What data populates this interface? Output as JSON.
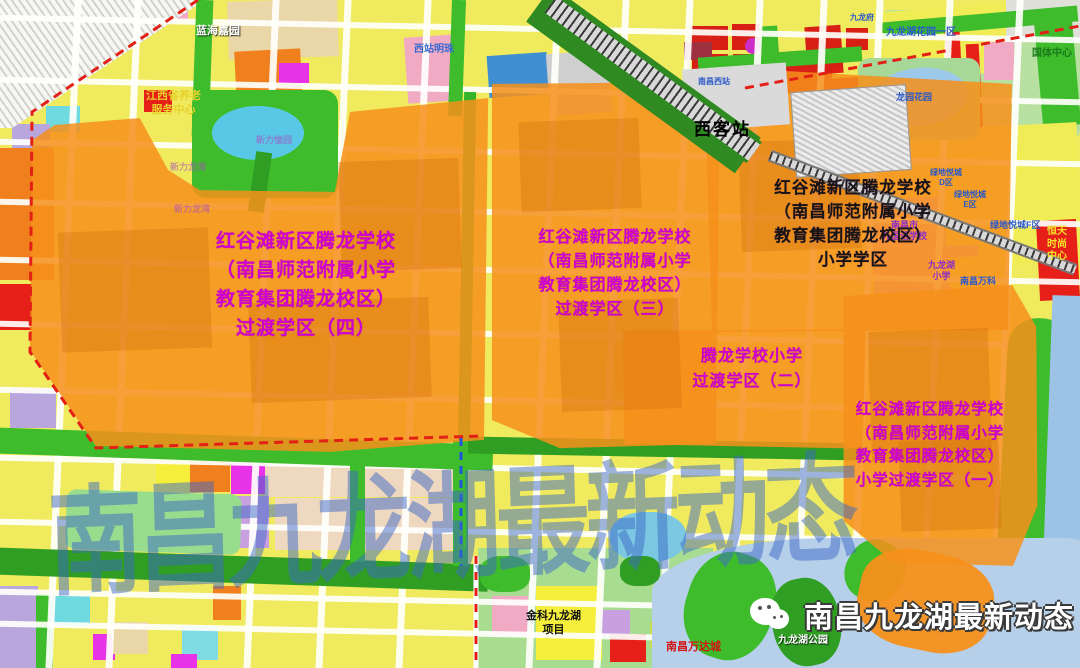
{
  "watermark": {
    "text": "南昌九龙湖最新动态"
  },
  "logo": {
    "text": "南昌九龙湖最新动态"
  },
  "station": {
    "label": "西客站"
  },
  "districts": [
    {
      "name": "过渡学区（四）",
      "lines": [
        "红谷滩新区腾龙学校",
        "（南昌师范附属小学",
        "教育集团腾龙校区）",
        "过渡学区（四）"
      ],
      "x": 175,
      "y": 227,
      "w": 262,
      "fs": 19,
      "lh": 29,
      "color": "#cf00cf"
    },
    {
      "name": "过渡学区（三）",
      "lines": [
        "红谷滩新区腾龙学校",
        "（南昌师范附属小学",
        "教育集团腾龙校区）",
        "过渡学区（三）"
      ],
      "x": 515,
      "y": 226,
      "w": 200,
      "fs": 16,
      "lh": 24,
      "color": "#cf00cf"
    },
    {
      "name": "小学学区",
      "lines": [
        "红谷滩新区腾龙学校",
        "（南昌师范附属小学",
        "教育集团腾龙校区）",
        "小学学区"
      ],
      "x": 742,
      "y": 176,
      "w": 222,
      "fs": 16.5,
      "lh": 24,
      "color": "#141414"
    },
    {
      "name": "过渡学区（二）",
      "lines": [
        "腾龙学校小学",
        "过渡学区（二）"
      ],
      "x": 668,
      "y": 344,
      "w": 168,
      "fs": 16,
      "lh": 25,
      "color": "#cf00cf"
    },
    {
      "name": "小学过渡学区（一）",
      "lines": [
        "红谷滩新区腾龙学校",
        "（南昌师范附属小学",
        "教育集团腾龙校区）",
        "小学过渡学区（一）"
      ],
      "x": 833,
      "y": 398,
      "w": 194,
      "fs": 15.5,
      "lh": 23.5,
      "color": "#cf00cf"
    }
  ],
  "map_labels": [
    {
      "text": "蓝海嘉园",
      "x": 196,
      "y": 25,
      "color": "#ffffff",
      "fs": 11,
      "shadow": true
    },
    {
      "text": "西站明珠",
      "x": 414,
      "y": 44,
      "color": "#3a6ad0",
      "fs": 10
    },
    {
      "text": "江西省养老\n服务中心",
      "x": 146,
      "y": 90,
      "color": "#e8d22a",
      "fs": 11
    },
    {
      "text": "南昌西站",
      "x": 698,
      "y": 77,
      "color": "#2a58c8",
      "fs": 8
    },
    {
      "text": "九龙府",
      "x": 850,
      "y": 13,
      "color": "#2a58c8",
      "fs": 8
    },
    {
      "text": "九龙湖花园一区",
      "x": 886,
      "y": 27,
      "color": "#2a58c8",
      "fs": 10
    },
    {
      "text": "龙园花园",
      "x": 896,
      "y": 92,
      "color": "#2a58c8",
      "fs": 9
    },
    {
      "text": "国体中心",
      "x": 1032,
      "y": 48,
      "color": "#1a7a1a",
      "fs": 10
    },
    {
      "text": "绿地悦城\nD区",
      "x": 930,
      "y": 168,
      "color": "#2a58c8",
      "fs": 8
    },
    {
      "text": "绿地悦城\nE区",
      "x": 954,
      "y": 190,
      "color": "#2a58c8",
      "fs": 8
    },
    {
      "text": "绿地悦城F区",
      "x": 990,
      "y": 220,
      "color": "#2a58c8",
      "fs": 9
    },
    {
      "text": "恒天\n时尚\n中心",
      "x": 1047,
      "y": 226,
      "color": "#f5e12a",
      "fs": 10
    },
    {
      "text": "南昌市\n外国语学校",
      "x": 882,
      "y": 220,
      "color": "#8a2cc8",
      "fs": 9
    },
    {
      "text": "九龙湖\n小学",
      "x": 928,
      "y": 260,
      "color": "#8a2cc8",
      "fs": 9
    },
    {
      "text": "南昌万科",
      "x": 960,
      "y": 276,
      "color": "#2a58c8",
      "fs": 9
    },
    {
      "text": "新力愉园",
      "x": 256,
      "y": 135,
      "color": "#a84cc0",
      "fs": 9,
      "op": 0.55
    },
    {
      "text": "新力龙湾",
      "x": 170,
      "y": 162,
      "color": "#a84cc0",
      "fs": 9,
      "op": 0.55
    },
    {
      "text": "新力龙湾",
      "x": 174,
      "y": 204,
      "color": "#a84cc0",
      "fs": 9,
      "op": 0.55
    },
    {
      "text": "金科九龙湖\n项目",
      "x": 526,
      "y": 610,
      "color": "#111111",
      "fs": 11
    },
    {
      "text": "南昌万达城",
      "x": 666,
      "y": 641,
      "color": "#d01414",
      "fs": 11
    },
    {
      "text": "九龙湖公园",
      "x": 778,
      "y": 635,
      "color": "#ffffff",
      "fs": 10,
      "shadow": true
    }
  ]
}
